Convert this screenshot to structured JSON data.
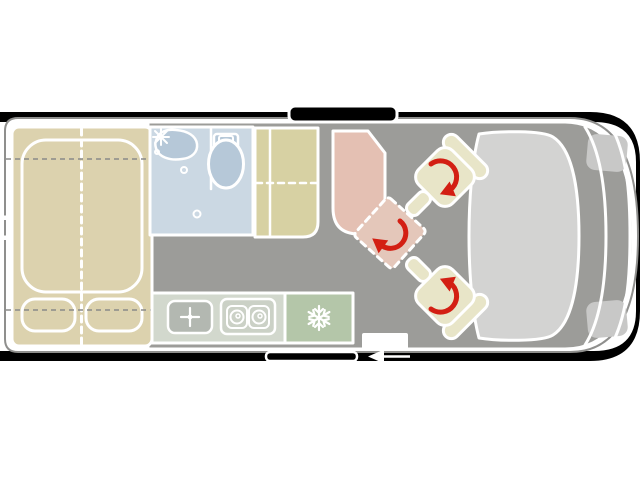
{
  "title": "Camper van floor plan (top view)",
  "colors": {
    "background": "#ffffff",
    "frame": "#000000",
    "body_line": "#8f8f8d",
    "wall": "#ffffff",
    "floor": "#9c9c99",
    "dash_line": "#8a8a88",
    "bed": "#dcd2ae",
    "bench": "#d7d1a3",
    "bathroom": "#cbd8e3",
    "fixture": "#b6c8d8",
    "table": "#e4c0b3",
    "swivel_seat": "#e4c7ba",
    "cab_seat": "#e8e5c8",
    "counter": "#d2d8cd",
    "sink_unit": "#b3b8b1",
    "stove_unit": "#cbd1c6",
    "fridge": "#b4c6a9",
    "windshield": "#d3d3d2",
    "headlight": "#c8c8c7",
    "arrow": "#d31f13",
    "icon": "#ffffff"
  },
  "features": {
    "rooms": [
      "rear-bed",
      "bathroom",
      "wardrobe-bench",
      "dinette-table",
      "kitchen",
      "cab"
    ],
    "icons": [
      "faucet-icon",
      "burner-icon",
      "snowflake-icon",
      "rotation-arrow-icon",
      "entry-arrow-icon"
    ],
    "fixtures": [
      "mattress",
      "pillows",
      "sink",
      "toilet",
      "kitchen-sink",
      "stove",
      "fridge",
      "swivel-seat-position",
      "driver-seat",
      "passenger-seat",
      "windshield",
      "skylight",
      "door-sill",
      "entry-step"
    ]
  }
}
